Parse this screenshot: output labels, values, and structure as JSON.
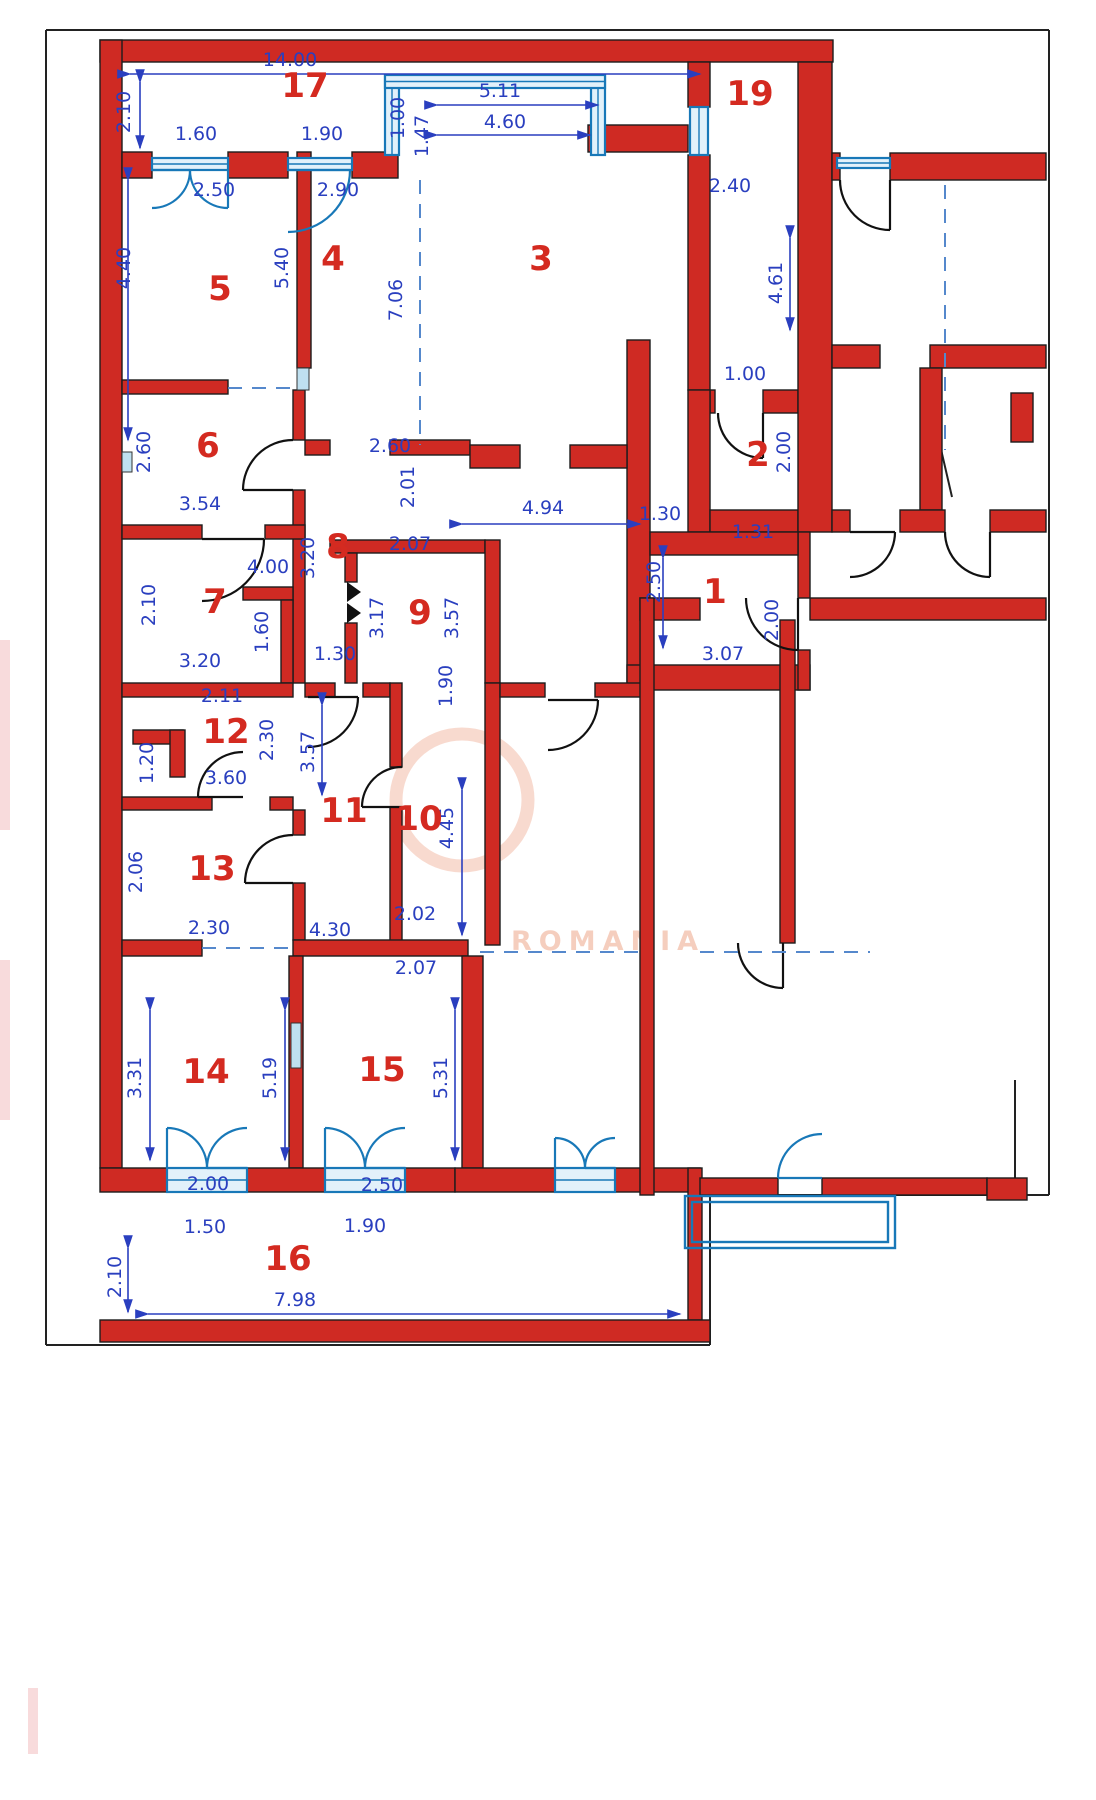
{
  "meta": {
    "title": "Apartment floor plan with room numbers and dimensions",
    "watermark_text": "ROMANIA"
  },
  "colors": {
    "wall": "#cf2a23",
    "wallStroke": "#1c1c1c",
    "dim": "#2a3fbf",
    "room": "#d42a20",
    "window": "#1878b8",
    "windowFill": "#e2f1fa",
    "pillar": "#bfe0f0",
    "frame": "#222222",
    "watermark": "#efae94",
    "smudge": "#f6cfd0"
  },
  "rooms": [
    {
      "n": "1",
      "x": 715,
      "y": 603
    },
    {
      "n": "2",
      "x": 758,
      "y": 466
    },
    {
      "n": "3",
      "x": 541,
      "y": 270
    },
    {
      "n": "4",
      "x": 333,
      "y": 270
    },
    {
      "n": "5",
      "x": 220,
      "y": 300
    },
    {
      "n": "6",
      "x": 208,
      "y": 457
    },
    {
      "n": "7",
      "x": 215,
      "y": 613
    },
    {
      "n": "8",
      "x": 338,
      "y": 558
    },
    {
      "n": "9",
      "x": 420,
      "y": 624
    },
    {
      "n": "10",
      "x": 419,
      "y": 830
    },
    {
      "n": "11",
      "x": 344,
      "y": 822
    },
    {
      "n": "12",
      "x": 226,
      "y": 743
    },
    {
      "n": "13",
      "x": 212,
      "y": 880
    },
    {
      "n": "14",
      "x": 206,
      "y": 1083
    },
    {
      "n": "15",
      "x": 382,
      "y": 1081
    },
    {
      "n": "16",
      "x": 288,
      "y": 1270
    },
    {
      "n": "17",
      "x": 305,
      "y": 97
    },
    {
      "n": "19",
      "x": 750,
      "y": 105
    }
  ],
  "dims": [
    {
      "t": "14.00",
      "x": 290,
      "y": 66,
      "r": 0
    },
    {
      "t": "2.10",
      "x": 130,
      "y": 112,
      "r": 1
    },
    {
      "t": "1.60",
      "x": 196,
      "y": 140,
      "r": 0
    },
    {
      "t": "1.90",
      "x": 322,
      "y": 140,
      "r": 0
    },
    {
      "t": "2.50",
      "x": 214,
      "y": 196,
      "r": 0
    },
    {
      "t": "2.90",
      "x": 338,
      "y": 196,
      "r": 0
    },
    {
      "t": "1.00",
      "x": 404,
      "y": 118,
      "r": 1
    },
    {
      "t": "1.47",
      "x": 428,
      "y": 136,
      "r": 1
    },
    {
      "t": "5.11",
      "x": 500,
      "y": 97,
      "r": 0
    },
    {
      "t": "4.60",
      "x": 505,
      "y": 128,
      "r": 0
    },
    {
      "t": "2.40",
      "x": 730,
      "y": 192,
      "r": 0
    },
    {
      "t": "4.61",
      "x": 782,
      "y": 283,
      "r": 1
    },
    {
      "t": "1.00",
      "x": 745,
      "y": 380,
      "r": 0
    },
    {
      "t": "7.06",
      "x": 402,
      "y": 300,
      "r": 1
    },
    {
      "t": "4.40",
      "x": 130,
      "y": 268,
      "r": 1
    },
    {
      "t": "5.40",
      "x": 288,
      "y": 268,
      "r": 1
    },
    {
      "t": "2.60",
      "x": 150,
      "y": 452,
      "r": 1
    },
    {
      "t": "3.54",
      "x": 200,
      "y": 510,
      "r": 0
    },
    {
      "t": "2.60",
      "x": 390,
      "y": 452,
      "r": 0
    },
    {
      "t": "2.01",
      "x": 414,
      "y": 487,
      "r": 1
    },
    {
      "t": "4.94",
      "x": 543,
      "y": 514,
      "r": 0
    },
    {
      "t": "2.00",
      "x": 790,
      "y": 452,
      "r": 1
    },
    {
      "t": "1.30",
      "x": 660,
      "y": 520,
      "r": 0
    },
    {
      "t": "1.31",
      "x": 753,
      "y": 538,
      "r": 0
    },
    {
      "t": "2.50",
      "x": 660,
      "y": 582,
      "r": 1
    },
    {
      "t": "3.07",
      "x": 723,
      "y": 660,
      "r": 0
    },
    {
      "t": "2.00",
      "x": 778,
      "y": 620,
      "r": 1
    },
    {
      "t": "2.10",
      "x": 155,
      "y": 605,
      "r": 1
    },
    {
      "t": "4.00",
      "x": 268,
      "y": 573,
      "r": 0
    },
    {
      "t": "1.60",
      "x": 268,
      "y": 632,
      "r": 1
    },
    {
      "t": "3.20",
      "x": 200,
      "y": 667,
      "r": 0
    },
    {
      "t": "3.20",
      "x": 314,
      "y": 558,
      "r": 1
    },
    {
      "t": "2.07",
      "x": 410,
      "y": 550,
      "r": 0
    },
    {
      "t": "3.17",
      "x": 383,
      "y": 618,
      "r": 1
    },
    {
      "t": "3.57",
      "x": 458,
      "y": 618,
      "r": 1
    },
    {
      "t": "1.30",
      "x": 335,
      "y": 660,
      "r": 0
    },
    {
      "t": "2.11",
      "x": 222,
      "y": 702,
      "r": 0
    },
    {
      "t": "2.30",
      "x": 273,
      "y": 740,
      "r": 1
    },
    {
      "t": "3.60",
      "x": 226,
      "y": 784,
      "r": 0
    },
    {
      "t": "1.20",
      "x": 153,
      "y": 763,
      "r": 1
    },
    {
      "t": "3.57",
      "x": 314,
      "y": 752,
      "r": 1
    },
    {
      "t": "1.90",
      "x": 452,
      "y": 686,
      "r": 1
    },
    {
      "t": "4.45",
      "x": 453,
      "y": 828,
      "r": 1
    },
    {
      "t": "2.06",
      "x": 142,
      "y": 872,
      "r": 1
    },
    {
      "t": "2.30",
      "x": 209,
      "y": 934,
      "r": 0
    },
    {
      "t": "4.30",
      "x": 330,
      "y": 936,
      "r": 0
    },
    {
      "t": "2.02",
      "x": 415,
      "y": 920,
      "r": 0
    },
    {
      "t": "2.07",
      "x": 416,
      "y": 974,
      "r": 0
    },
    {
      "t": "3.31",
      "x": 141,
      "y": 1078,
      "r": 1
    },
    {
      "t": "5.19",
      "x": 276,
      "y": 1078,
      "r": 1
    },
    {
      "t": "5.31",
      "x": 447,
      "y": 1078,
      "r": 1
    },
    {
      "t": "2.00",
      "x": 208,
      "y": 1190,
      "r": 0
    },
    {
      "t": "2.50",
      "x": 382,
      "y": 1191,
      "r": 0
    },
    {
      "t": "1.50",
      "x": 205,
      "y": 1233,
      "r": 0
    },
    {
      "t": "1.90",
      "x": 365,
      "y": 1232,
      "r": 0
    },
    {
      "t": "2.10",
      "x": 121,
      "y": 1277,
      "r": 1
    },
    {
      "t": "7.98",
      "x": 295,
      "y": 1306,
      "r": 0
    }
  ],
  "walls": [
    [
      100,
      40,
      733,
      22
    ],
    [
      100,
      40,
      22,
      1128
    ],
    [
      122,
      152,
      30,
      26
    ],
    [
      228,
      152,
      60,
      26
    ],
    [
      352,
      152,
      46,
      26
    ],
    [
      588,
      125,
      100,
      27
    ],
    [
      688,
      62,
      22,
      45
    ],
    [
      688,
      155,
      22,
      235
    ],
    [
      710,
      390,
      5,
      23
    ],
    [
      763,
      390,
      35,
      23
    ],
    [
      688,
      390,
      22,
      142
    ],
    [
      710,
      510,
      88,
      22
    ],
    [
      798,
      62,
      34,
      470
    ],
    [
      627,
      340,
      23,
      350
    ],
    [
      627,
      665,
      183,
      25
    ],
    [
      798,
      532,
      12,
      66
    ],
    [
      798,
      650,
      12,
      40
    ],
    [
      650,
      532,
      148,
      23
    ],
    [
      297,
      152,
      14,
      216
    ],
    [
      122,
      380,
      106,
      14
    ],
    [
      293,
      390,
      12,
      50
    ],
    [
      293,
      490,
      12,
      193
    ],
    [
      122,
      525,
      80,
      14
    ],
    [
      265,
      525,
      40,
      14
    ],
    [
      243,
      587,
      50,
      13
    ],
    [
      281,
      600,
      12,
      83
    ],
    [
      305,
      440,
      25,
      15
    ],
    [
      390,
      440,
      80,
      15
    ],
    [
      470,
      445,
      50,
      23
    ],
    [
      570,
      445,
      57,
      23
    ],
    [
      330,
      540,
      155,
      13
    ],
    [
      345,
      553,
      12,
      29
    ],
    [
      345,
      623,
      12,
      60
    ],
    [
      485,
      540,
      15,
      143
    ],
    [
      122,
      683,
      171,
      14
    ],
    [
      305,
      683,
      30,
      14
    ],
    [
      363,
      683,
      27,
      14
    ],
    [
      390,
      683,
      12,
      84
    ],
    [
      390,
      807,
      12,
      138
    ],
    [
      485,
      683,
      15,
      262
    ],
    [
      500,
      683,
      45,
      14
    ],
    [
      595,
      683,
      55,
      14
    ],
    [
      133,
      730,
      50,
      14
    ],
    [
      170,
      730,
      15,
      47
    ],
    [
      122,
      797,
      90,
      13
    ],
    [
      270,
      797,
      23,
      13
    ],
    [
      293,
      810,
      12,
      25
    ],
    [
      293,
      883,
      12,
      57
    ],
    [
      122,
      940,
      80,
      16
    ],
    [
      293,
      940,
      175,
      16
    ],
    [
      289,
      956,
      14,
      212
    ],
    [
      462,
      956,
      21,
      212
    ],
    [
      100,
      1168,
      67,
      24
    ],
    [
      247,
      1168,
      78,
      24
    ],
    [
      405,
      1168,
      50,
      24
    ],
    [
      455,
      1168,
      100,
      24
    ],
    [
      615,
      1168,
      85,
      24
    ],
    [
      688,
      1168,
      14,
      152
    ],
    [
      100,
      1320,
      610,
      22
    ],
    [
      700,
      1178,
      78,
      17
    ],
    [
      822,
      1178,
      165,
      17
    ],
    [
      987,
      1178,
      40,
      22
    ],
    [
      832,
      153,
      8,
      27
    ],
    [
      890,
      153,
      156,
      27
    ],
    [
      832,
      345,
      48,
      23
    ],
    [
      930,
      345,
      116,
      23
    ],
    [
      920,
      368,
      22,
      142
    ],
    [
      832,
      510,
      18,
      22
    ],
    [
      900,
      510,
      45,
      22
    ],
    [
      990,
      510,
      56,
      22
    ],
    [
      810,
      598,
      236,
      22
    ],
    [
      640,
      598,
      60,
      22
    ],
    [
      640,
      598,
      14,
      597
    ],
    [
      780,
      620,
      15,
      323
    ],
    [
      1011,
      393,
      22,
      49
    ]
  ],
  "pillars": [
    [
      297,
      368,
      12,
      22
    ],
    [
      291,
      1023,
      10,
      45
    ],
    [
      122,
      452,
      10,
      20
    ]
  ],
  "windows": [
    [
      152,
      158,
      76,
      12
    ],
    [
      288,
      158,
      64,
      12
    ],
    [
      385,
      75,
      14,
      80
    ],
    [
      591,
      75,
      14,
      80
    ],
    [
      385,
      75,
      220,
      13
    ],
    [
      690,
      107,
      18,
      48
    ],
    [
      837,
      158,
      53,
      10
    ],
    [
      167,
      1168,
      80,
      24
    ],
    [
      325,
      1168,
      80,
      24
    ],
    [
      555,
      1168,
      60,
      24
    ]
  ],
  "outline_rects": [
    [
      685,
      1196,
      210,
      52
    ],
    [
      692,
      1202,
      196,
      40
    ]
  ],
  "arcs": [
    [
      293,
      490,
      50,
      180,
      270,
      "b"
    ],
    [
      202,
      539,
      62,
      0,
      90,
      "b"
    ],
    [
      243,
      797,
      45,
      180,
      270,
      "b"
    ],
    [
      293,
      883,
      48,
      180,
      270,
      "b"
    ],
    [
      402,
      807,
      40,
      180,
      270,
      "b"
    ],
    [
      548,
      700,
      50,
      0,
      90,
      "b"
    ],
    [
      308,
      697,
      50,
      0,
      90,
      "b"
    ],
    [
      763,
      413,
      45,
      90,
      180,
      "b"
    ],
    [
      798,
      598,
      52,
      90,
      180,
      "b"
    ],
    [
      890,
      180,
      50,
      90,
      180,
      "b"
    ],
    [
      850,
      532,
      45,
      0,
      90,
      "b"
    ],
    [
      990,
      532,
      45,
      90,
      180,
      "b"
    ],
    [
      783,
      943,
      45,
      90,
      180,
      "b"
    ],
    [
      152,
      170,
      38,
      0,
      90,
      "u"
    ],
    [
      228,
      170,
      38,
      90,
      180,
      "u"
    ],
    [
      288,
      170,
      62,
      0,
      90,
      "u"
    ],
    [
      167,
      1168,
      40,
      270,
      360,
      "u"
    ],
    [
      247,
      1168,
      40,
      180,
      270,
      "u"
    ],
    [
      325,
      1168,
      40,
      270,
      360,
      "u"
    ],
    [
      405,
      1168,
      40,
      180,
      270,
      "u"
    ],
    [
      555,
      1168,
      30,
      270,
      360,
      "u"
    ],
    [
      615,
      1168,
      30,
      180,
      270,
      "u"
    ],
    [
      822,
      1178,
      44,
      180,
      270,
      "u"
    ]
  ],
  "bifold": [
    [
      347,
      582
    ],
    [
      347,
      603
    ]
  ],
  "dashes": [
    [
      228,
      388,
      297,
      388
    ],
    [
      420,
      180,
      420,
      445
    ],
    [
      945,
      185,
      945,
      450
    ],
    [
      202,
      948,
      293,
      948
    ],
    [
      480,
      952,
      640,
      952
    ],
    [
      700,
      952,
      870,
      952
    ]
  ],
  "blacklines": [
    [
      46,
      30,
      1049,
      30
    ],
    [
      46,
      30,
      46,
      1345
    ],
    [
      46,
      1345,
      710,
      1345
    ],
    [
      1049,
      30,
      1049,
      1195
    ],
    [
      710,
      1195,
      1049,
      1195
    ],
    [
      710,
      1195,
      710,
      1345
    ],
    [
      1015,
      1080,
      1015,
      1195
    ],
    [
      940,
      445,
      952,
      497
    ]
  ],
  "dimlines": [
    [
      130,
      74,
      700,
      74
    ],
    [
      437,
      105,
      598,
      105
    ],
    [
      437,
      135,
      590,
      135
    ],
    [
      148,
      1314,
      680,
      1314
    ],
    [
      462,
      524,
      640,
      524
    ],
    [
      128,
      180,
      128,
      440
    ],
    [
      140,
      82,
      140,
      148
    ],
    [
      790,
      238,
      790,
      330
    ],
    [
      285,
      1010,
      285,
      1160
    ],
    [
      455,
      1010,
      455,
      1160
    ],
    [
      150,
      1010,
      150,
      1160
    ],
    [
      128,
      1248,
      128,
      1312
    ],
    [
      462,
      790,
      462,
      935
    ],
    [
      322,
      705,
      322,
      795
    ],
    [
      663,
      558,
      663,
      648
    ]
  ],
  "smudges": [
    [
      0,
      640,
      10,
      190
    ],
    [
      0,
      960,
      10,
      160
    ],
    [
      28,
      1688,
      10,
      66
    ]
  ],
  "watermark": {
    "x": 608,
    "y": 950,
    "ring": {
      "cx": 462,
      "cy": 800,
      "r": 66
    }
  }
}
